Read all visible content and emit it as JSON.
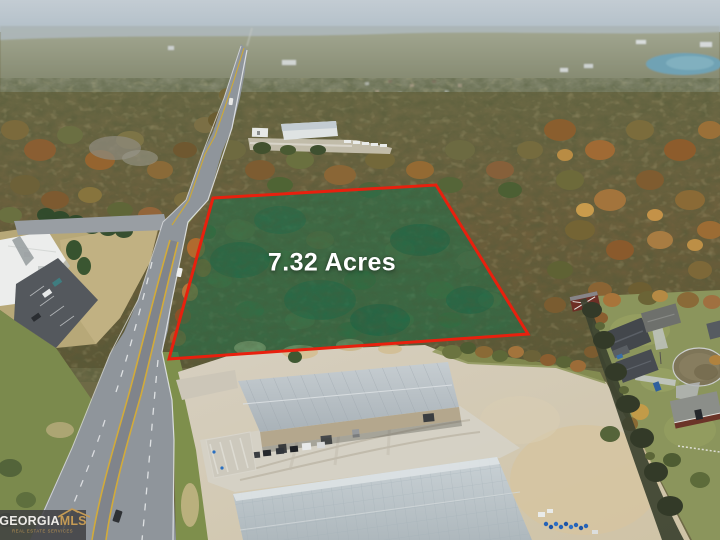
{
  "overlay": {
    "acreage_label": "7.32 Acres"
  },
  "watermark": {
    "brand_primary": "GEORGIA",
    "brand_secondary": "MLS",
    "tagline": "REAL ESTATE SERVICES"
  },
  "colors": {
    "boundary_red": "#e8200e",
    "parcel_green": "#0f7a52",
    "label_white": "#ffffff",
    "logo_gold": "#c59b55",
    "logo_text": "#edebe7",
    "logo_bg": "rgba(64,64,66,0.85)",
    "sky_blue": "#bfcad2",
    "lake_blue": "#6fa2b4",
    "road_asphalt": "#8f959b",
    "roof_gray": "#b8c1c6",
    "autumn_forest": "#7a6238",
    "grass_green": "#7e8f4c"
  },
  "scene": {
    "description": "Aerial drone photo: wooded 7.32-acre parcel outlined in red along a highway, warehouses in foreground, autumn forest and residential cul-de-sac at right, town and lake on the horizon."
  }
}
